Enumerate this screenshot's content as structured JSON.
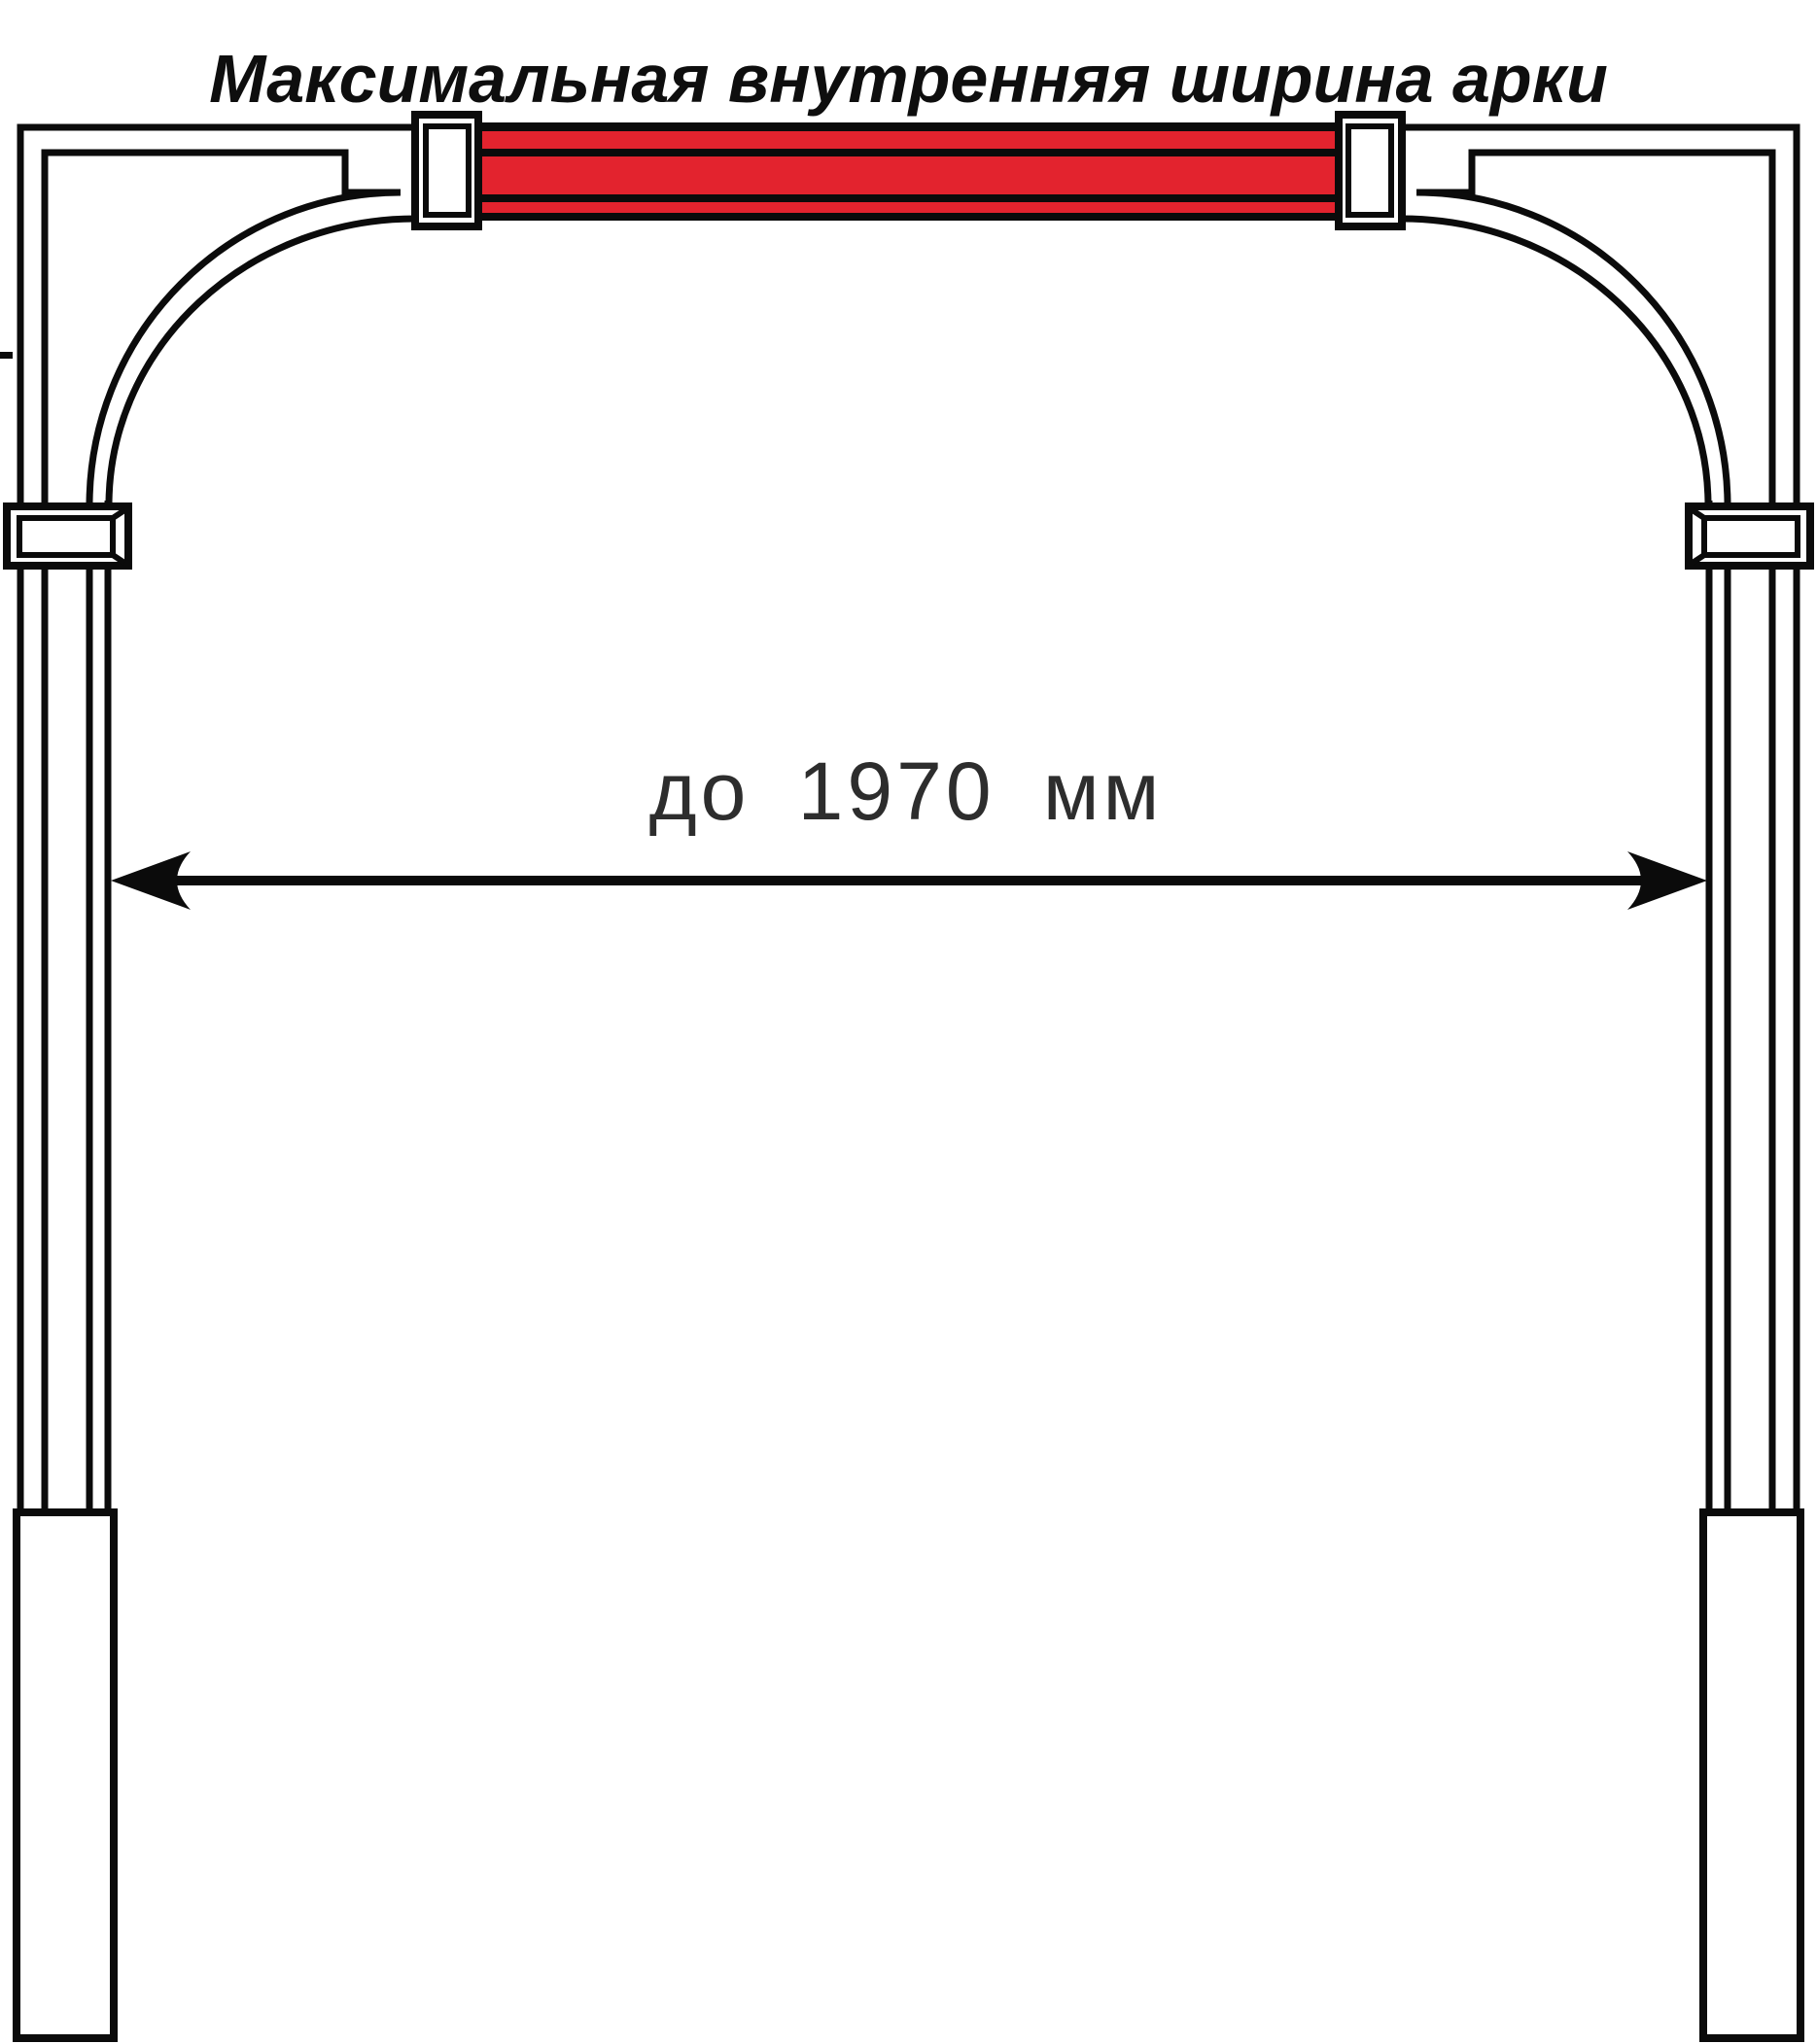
{
  "title": "Максимальная внутренняя ширина арки",
  "dimension": {
    "label": "до 1970 мм"
  },
  "colors": {
    "line": "#0b0b0b",
    "red": "#e3232e",
    "dim_text": "#2d2d2d",
    "background": "#ffffff"
  }
}
